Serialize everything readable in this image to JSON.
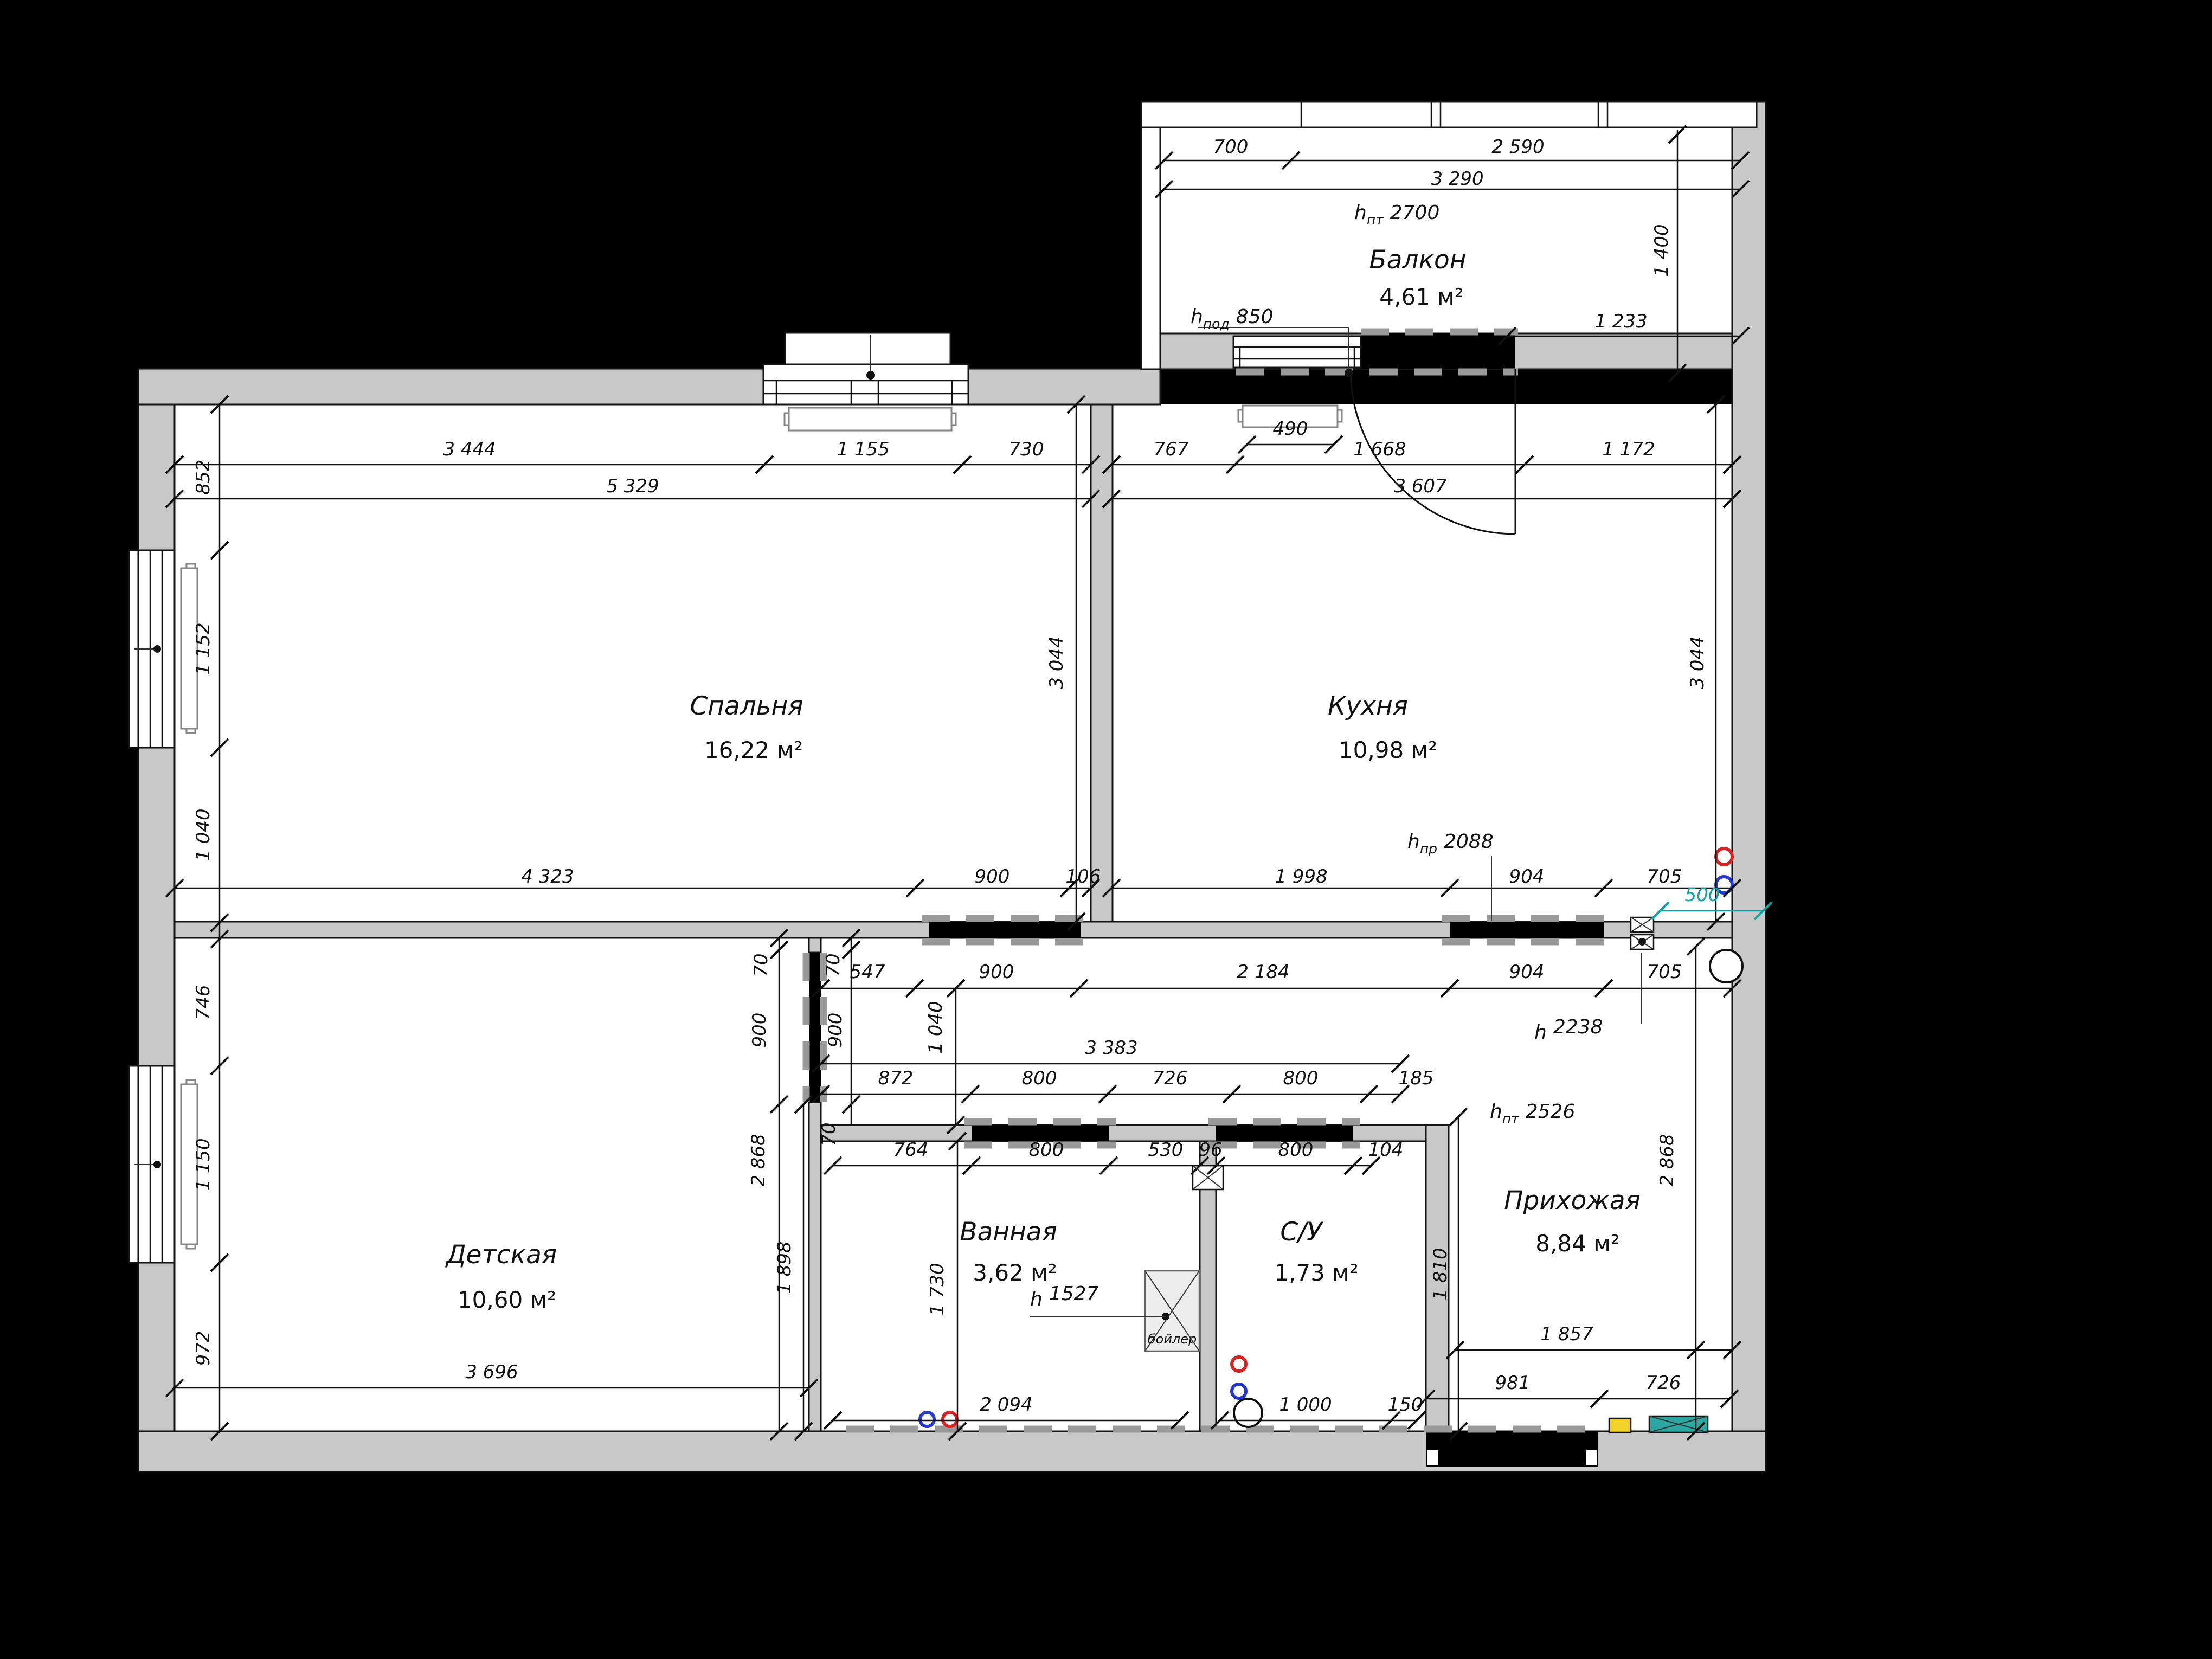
{
  "rooms": {
    "bedroom": {
      "name": "Спальня",
      "area": "16,22 м²"
    },
    "kitchen": {
      "name": "Кухня",
      "area": "10,98 м²"
    },
    "children": {
      "name": "Детская",
      "area": "10,60 м²"
    },
    "bathroom": {
      "name": "Ванная",
      "area": "3,62 м²"
    },
    "wc": {
      "name": "С/У",
      "area": "1,73 м²"
    },
    "hall": {
      "name": "Прихожая",
      "area": "8,84 м²"
    },
    "balcony": {
      "name": "Балкон",
      "area": "4,61 м²"
    }
  },
  "height_marks": {
    "balcony_ceiling": {
      "prefix": "h",
      "sub": "пт",
      "value": "2700"
    },
    "balcony_sill": {
      "prefix": "h",
      "sub": "под",
      "value": "850"
    },
    "kitchen_passage": {
      "prefix": "h",
      "sub": "пр",
      "value": "2088"
    },
    "hall_ceiling": {
      "prefix": "h",
      "sub": "пт",
      "value": "2526"
    },
    "niche": {
      "prefix": "h",
      "sub": "",
      "value": "2238"
    },
    "boiler": {
      "prefix": "h",
      "sub": "",
      "value": "1527"
    }
  },
  "misc": {
    "boiler_label": "бойлер"
  },
  "dims": {
    "bal_700": "700",
    "bal_2590": "2 590",
    "bal_3290": "3 290",
    "bal_1233": "1 233",
    "bal_1400": "1 400",
    "bed_3444": "3 444",
    "bed_1155": "1 155",
    "bed_730": "730",
    "bed_5329": "5 329",
    "kit_767": "767",
    "kit_490": "490",
    "kit_1668": "1 668",
    "kit_1172": "1 172",
    "kit_3607": "3 607",
    "left_852": "852",
    "left_1152": "1 152",
    "left_1040": "1 040",
    "left_746": "746",
    "left_1150": "1 150",
    "left_972": "972",
    "bed_3044": "3 044",
    "kit_3044": "3 044",
    "bed_4323": "4 323",
    "bed_900": "900",
    "bed_106": "106",
    "kit_1998": "1 998",
    "kit_904": "904",
    "kit_705": "705",
    "teal_500": "500",
    "cor_547": "547",
    "cor_900": "900",
    "cor_2184": "2 184",
    "cor_904": "904",
    "cor_705": "705",
    "duct_70a": "70",
    "duct_70b": "70",
    "duct_70c": "70",
    "duct_900a": "900",
    "duct_900b": "900",
    "cor_1040": "1 040",
    "bath_3383": "3 383",
    "bath_872": "872",
    "bath_800a": "800",
    "bath_726": "726",
    "bath_800b": "800",
    "bath_185": "185",
    "bath_764": "764",
    "bath_800c": "800",
    "bath_530": "530",
    "bath_96": "96",
    "bath_800d": "800",
    "bath_104": "104",
    "bath_1730": "1 730",
    "bath_2094": "2 094",
    "wc_1000": "1 000",
    "wc_150": "150",
    "hall_1810": "1 810",
    "hall_2868": "2 868",
    "hall_1857": "1 857",
    "hall_981": "981",
    "hall_726": "726",
    "child_3696": "3 696",
    "child_2868": "2 868",
    "child_1898": "1 898"
  },
  "colors": {
    "wall_fill": "#c8c8c8",
    "opening": "#000000",
    "lintel_dash": "#9a9a9a",
    "teal_dim": "#00a5a5",
    "cabinet_teal": "#2aa7a0",
    "panel_yellow": "#f2d32b",
    "riser_hot": "#d92121",
    "riser_cold": "#2437cf"
  }
}
